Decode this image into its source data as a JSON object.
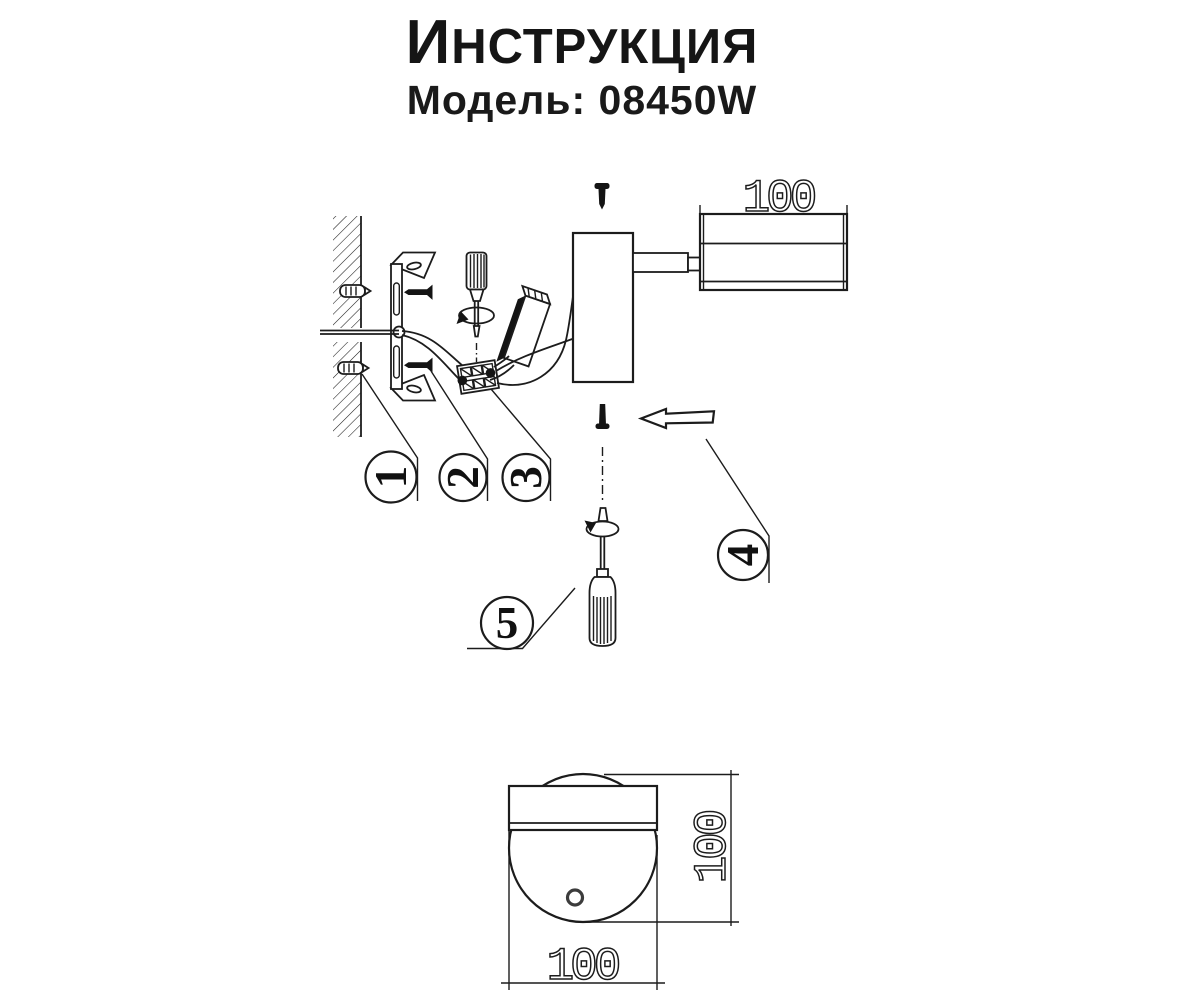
{
  "colors": {
    "ink": "#1c1c1c",
    "background": "#ffffff"
  },
  "header": {
    "title_initial": "И",
    "title_rest": "НСТРУКЦИЯ",
    "model": "Модель: 08450W"
  },
  "diagram": {
    "callouts": {
      "c1": "1",
      "c2": "2",
      "c3": "3",
      "c4": "4",
      "c5": "5"
    },
    "dimensions": {
      "lamp_head_length": "100",
      "front_view_height": "100",
      "front_view_width": "100"
    }
  }
}
